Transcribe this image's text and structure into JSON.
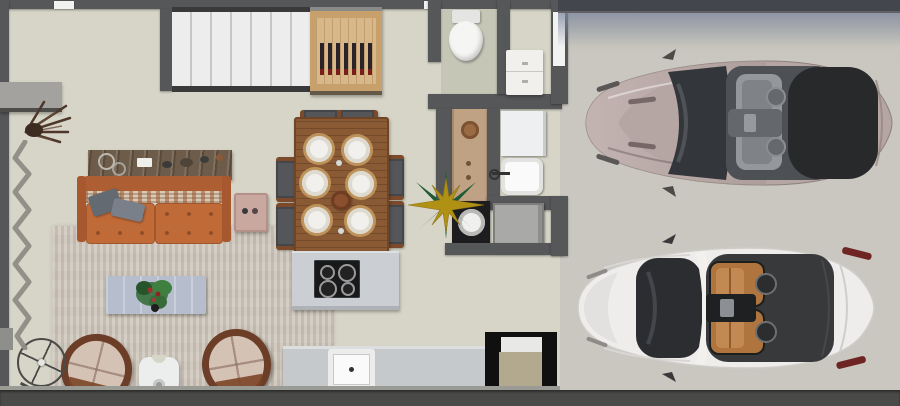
{
  "scene": {
    "description": "Top-down 3D rendered floor plan of an apartment: living room, dining area, kitchen, bathroom and laundry on the left; two-car garage with two convertibles on the right",
    "width": 900,
    "height": 406
  },
  "colors": {
    "wall": "#565759",
    "house_floor": "#d7d5c7",
    "bathroom_floor": "#c5c6b6",
    "garage_floor": "#c9c7bf",
    "rug": "#cdc5b9",
    "stairs": "#efefef",
    "wine_cabinet_wood": "#c7a06b",
    "wine_bottle": "#2b2328",
    "sofa_leather": "#c06a38",
    "console_wood": "#6e5c4a",
    "coffee_table": "#b6bece",
    "armchair_leather": "#6d3e27",
    "armchair_cushion": "#d4c2b5",
    "dining_table_wood": "#8a5a35",
    "dining_chair": "#54565a",
    "plate": "#f1f0ec",
    "kitchen_island": "#cbcfd3",
    "cooktop": "#18191b",
    "counter": "#c6c9cb",
    "sink": "#fafafa",
    "pantry_frame": "#101010",
    "pantry_inside": "#b2a98f",
    "appliance_gray": "#a9a9a7",
    "washer_dark": "#1d1d1f",
    "toilet": "#f5f5f3",
    "vanity": "#f1f0ec",
    "star_gold": "#b09114",
    "star_green": "#1e5a32",
    "garage_door": "#43464c",
    "driveway_edge": "#4a4a48",
    "car_top_body": "#b5a5a3",
    "car_top_cockpit": "#4d5054",
    "car_top_tonneau": "#28292b",
    "car_white_body": "#eeedeb",
    "car_white_glass": "#2b2d30",
    "car_white_seats": "#b0753f",
    "car_white_tonneau": "#38393b",
    "taillight_red": "#6f2523"
  },
  "house": {
    "rooms": [
      "entry-hall",
      "living-room",
      "dining-area",
      "kitchen",
      "bathroom",
      "laundry"
    ],
    "objects": [
      "staircase",
      "wine-cabinet",
      "console-table",
      "leather-sofa",
      "throw-pillows",
      "side-table",
      "coffee-table",
      "plant",
      "round-armchair-left",
      "round-armchair-right",
      "accent-table",
      "ceiling-fan",
      "zigzag-decor",
      "dried-branch",
      "dining-table",
      "six-dining-chairs",
      "six-plates",
      "centerpiece",
      "kitchen-island",
      "cooktop",
      "kitchen-counter",
      "kitchen-sink",
      "pantry",
      "toilet",
      "vanity",
      "hall-cabinet",
      "laundry-cabinet",
      "laundry-sink",
      "front-load-washer",
      "top-washer",
      "compass-star-ornament"
    ]
  },
  "garage": {
    "objects": [
      "garage-door",
      "driveway-edge"
    ],
    "vehicles": [
      {
        "name": "convertible-champagne",
        "body_color": "#b5a5a3",
        "interior": "gray"
      },
      {
        "name": "convertible-white",
        "body_color": "#eeedeb",
        "interior": "cognac"
      }
    ]
  }
}
